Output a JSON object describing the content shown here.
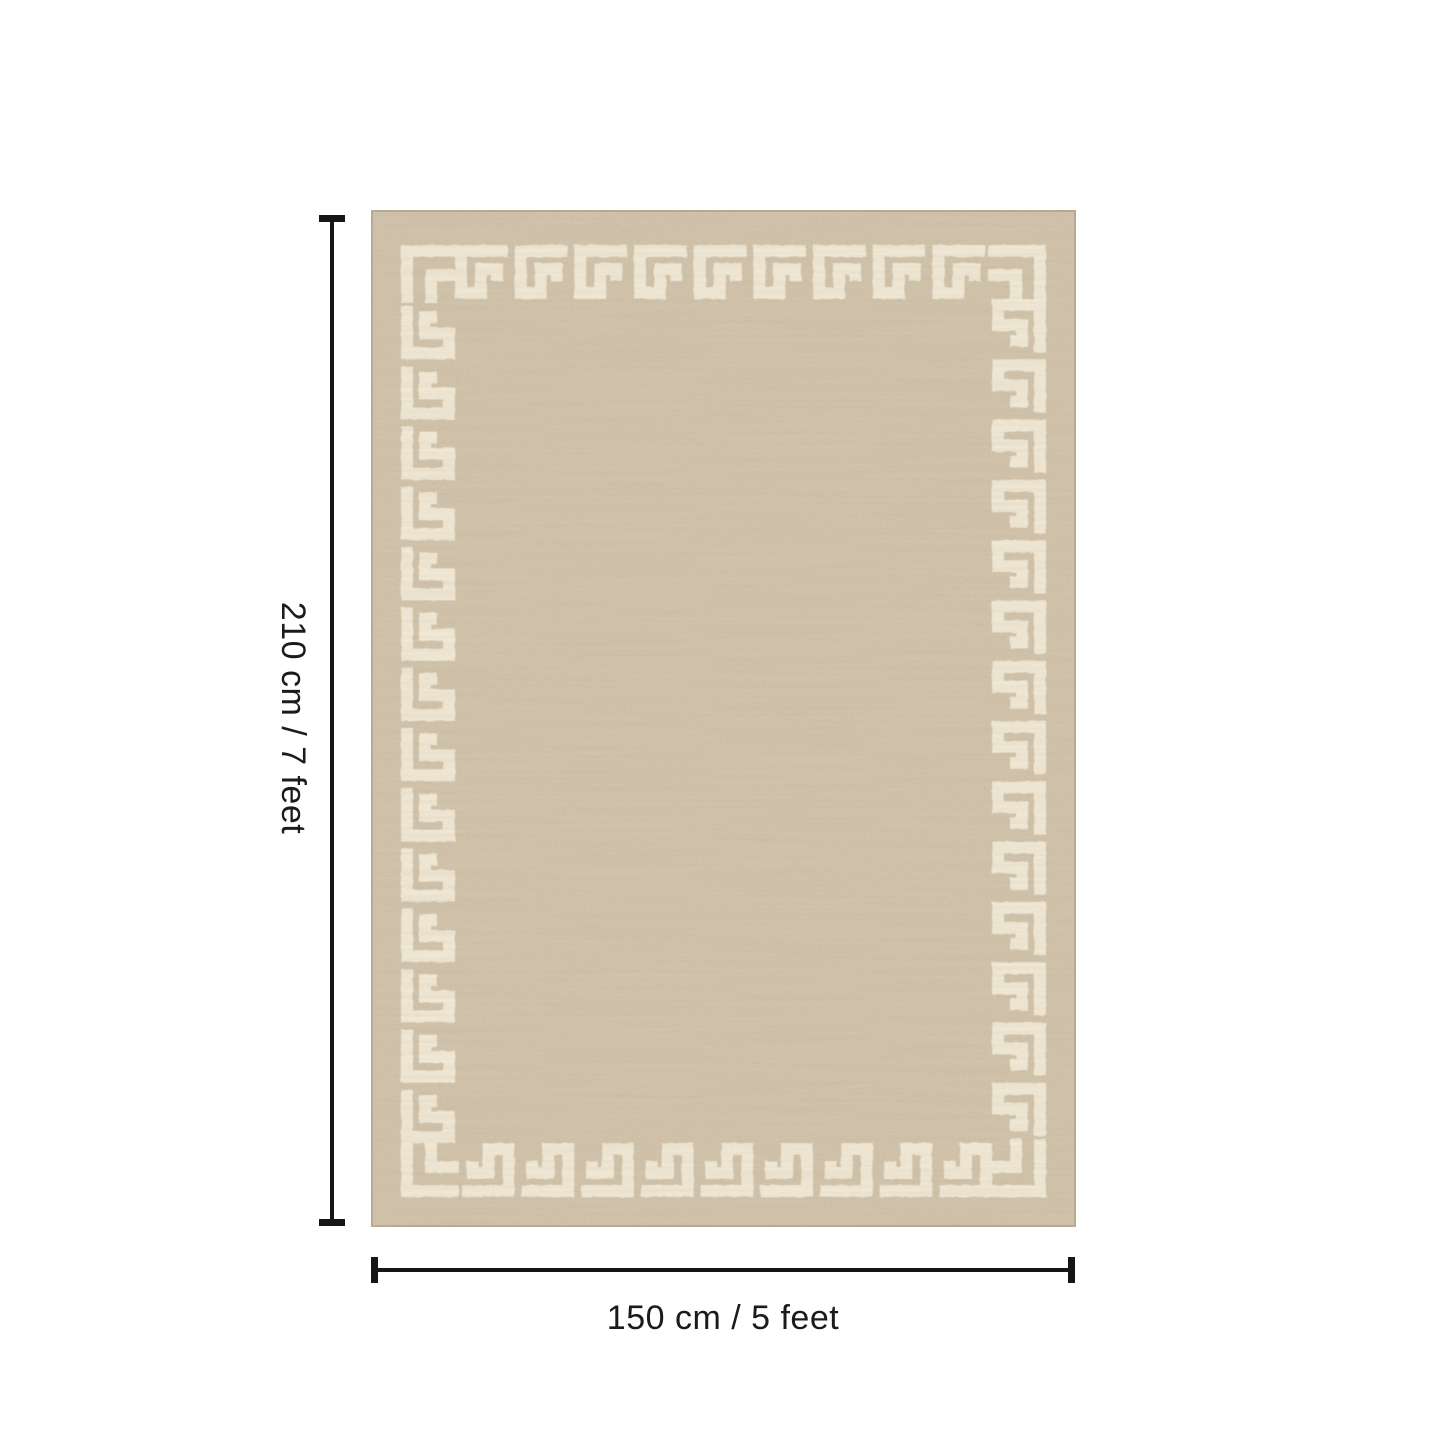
{
  "page": {
    "background_color": "#ffffff"
  },
  "diagram": {
    "type": "rug-size-diagram",
    "height_label": "210 cm / 7 feet",
    "width_label": "150 cm / 5 feet",
    "dimension_line_color": "#161616",
    "rug": {
      "pattern_name": "greek-key-border",
      "base_color": "#d0c1a8",
      "pattern_color": "#f4edda"
    }
  }
}
